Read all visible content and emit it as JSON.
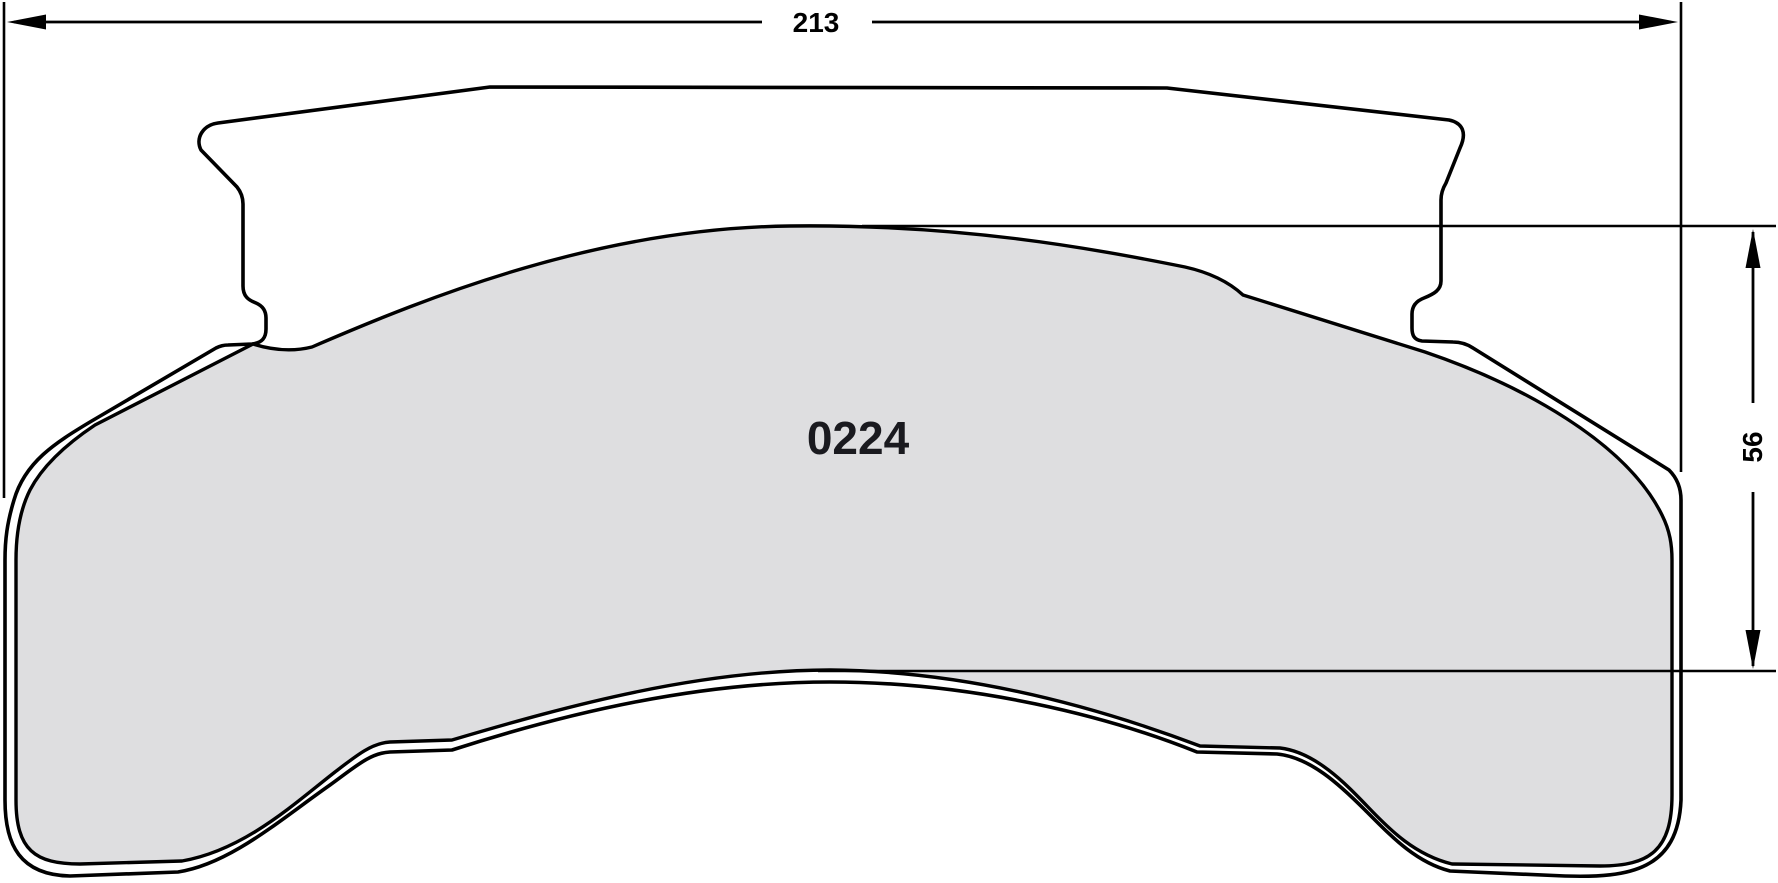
{
  "drawing": {
    "part_number": "0224",
    "width_dimension_label": "213",
    "height_dimension_label": "56",
    "colors": {
      "line": "#000000",
      "plate_fill": "#ffffff",
      "friction_fill": "#dedee0",
      "background": "#ffffff"
    }
  }
}
